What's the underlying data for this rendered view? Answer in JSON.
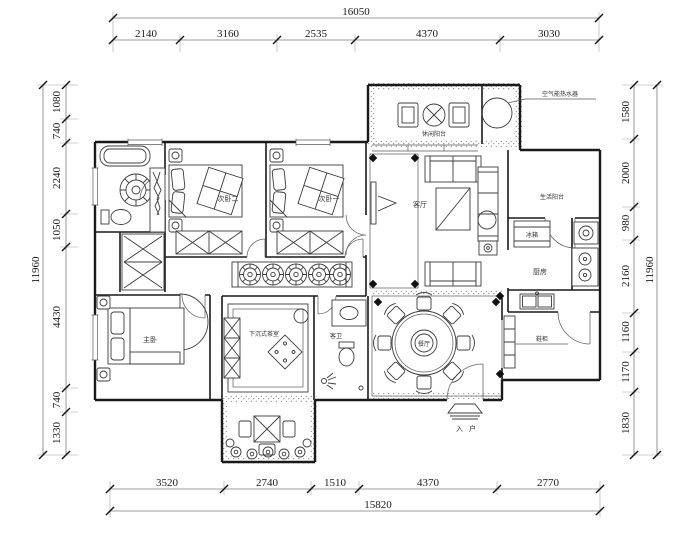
{
  "plan": {
    "dimensions": {
      "top": {
        "total": "16050",
        "segments": [
          "2140",
          "3160",
          "2535",
          "4370",
          "3030"
        ]
      },
      "bottom": {
        "total": "15820",
        "segments": [
          "3520",
          "2740",
          "1510",
          "4370",
          "2770"
        ]
      },
      "left": {
        "total": "11960",
        "segments": [
          "1080",
          "740",
          "2240",
          "1050",
          "4430",
          "740",
          "1330"
        ]
      },
      "right": {
        "total": "11960",
        "segments": [
          "1580",
          "2000",
          "980",
          "2160",
          "1160",
          "1170",
          "1830"
        ]
      }
    },
    "labels": {
      "bedroom2": "次卧二",
      "bedroom1": "次卧一",
      "living": "客厅",
      "leisure_balcony": "休闲阳台",
      "water_heater": "空气能热水器",
      "service_balcony": "生活阳台",
      "fridge": "冰箱",
      "kitchen": "厨房",
      "dining": "餐厅",
      "master": "主卧",
      "tea_room": "下沉式茶室",
      "bathroom": "客卫",
      "shoe_cabinet": "鞋柜",
      "entry": "入户"
    },
    "colors": {
      "wall": "#1a1a1a",
      "dim_line": "#7d7d7d",
      "pattern": "#c9c9c9"
    }
  }
}
